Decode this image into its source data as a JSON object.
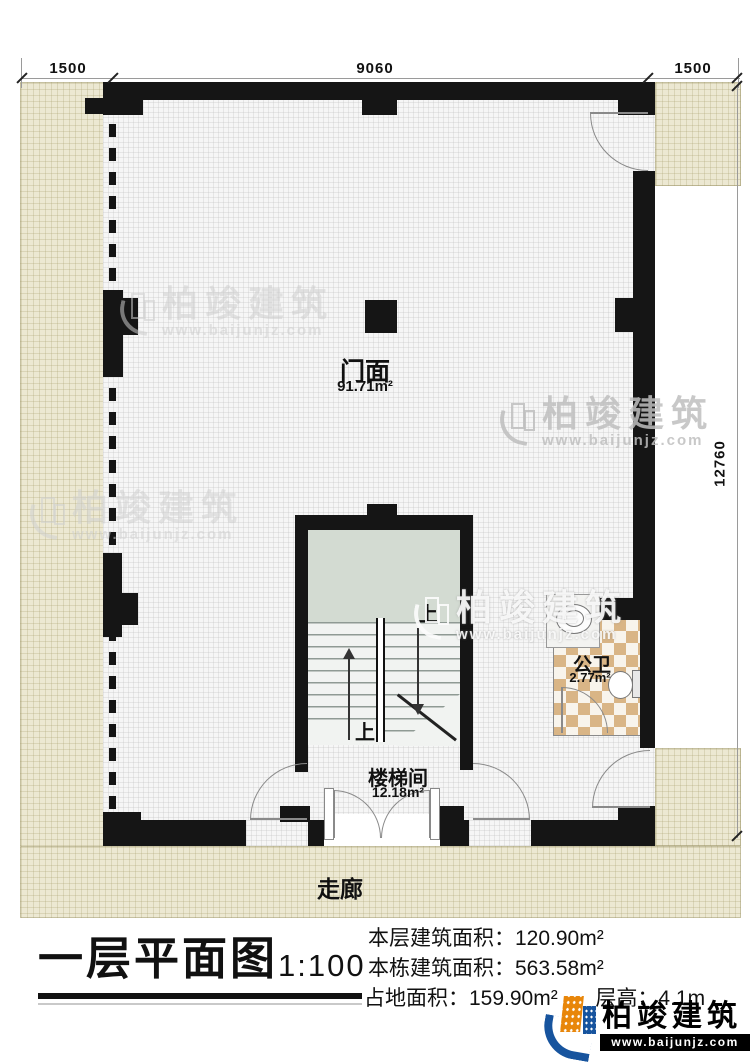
{
  "plan": {
    "dim_top_left": "1500",
    "dim_top_mid": "9060",
    "dim_top_right": "1500",
    "dim_right": "12760",
    "storefront_name": "门面",
    "storefront_area": "91.71m²",
    "stairwell_name": "楼梯间",
    "stairwell_area": "12.18m²",
    "toilet_name": "公卫",
    "toilet_area": "2.77m²",
    "corridor_name": "走廊",
    "stair_up_top": "上",
    "stair_up_bottom": "上"
  },
  "title_block": {
    "title": "一层平面图",
    "scale": "1:100",
    "stats": [
      {
        "label": "本层建筑面积：",
        "value": "120.90m²"
      },
      {
        "label": "本栋建筑面积：",
        "value": "563.58m²"
      },
      {
        "label": "占地面积：",
        "value": "159.90m²"
      },
      {
        "label": "层高：",
        "value": "4.1m"
      }
    ]
  },
  "branding": {
    "name": "柏竣建筑",
    "url": "www.baijunjz.com"
  },
  "watermark": {
    "name": "柏竣建筑",
    "url": "www.baijunjz.com"
  },
  "colors": {
    "wall": "#151515",
    "beige": "#ece8d2",
    "tile_tan": "#d9b586",
    "accent_orange": "#e8860a",
    "accent_blue": "#17549e"
  }
}
